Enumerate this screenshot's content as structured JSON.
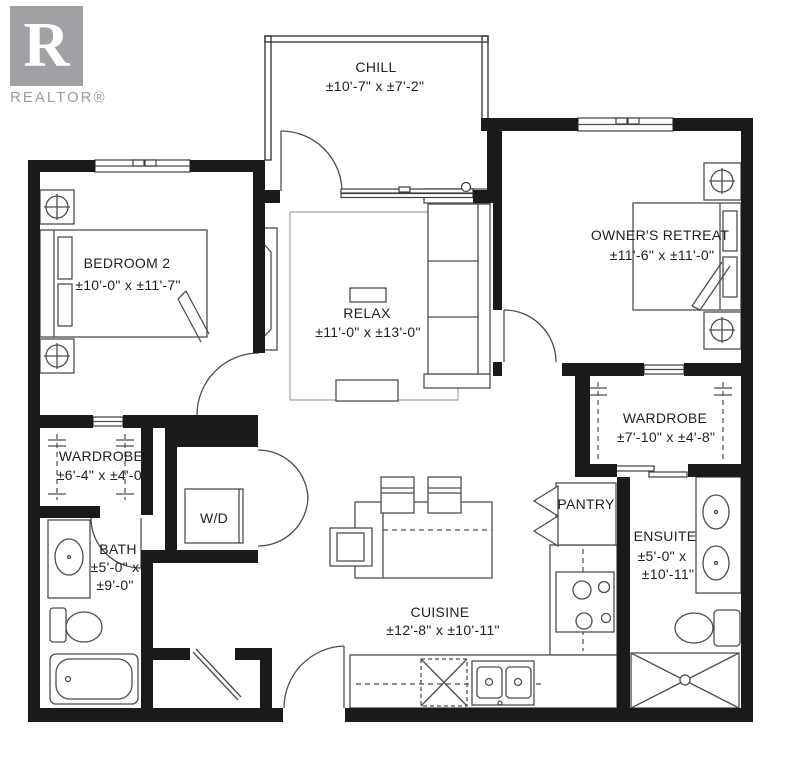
{
  "logo": {
    "letter": "R",
    "brand": "REALTOR®"
  },
  "rooms": {
    "chill": {
      "name": "CHILL",
      "dims": "±10'-7\" x ±7'-2\""
    },
    "bedroom2": {
      "name": "BEDROOM 2",
      "dims": "±10'-0\" x ±11'-7\""
    },
    "relax": {
      "name": "RELAX",
      "dims": "±11'-0\" x ±13'-0\""
    },
    "owners": {
      "name": "OWNER'S RETREAT",
      "dims": "±11'-6\" x ±11'-0\""
    },
    "wardrobe_right": {
      "name": "WARDROBE",
      "dims": "±7'-10\" x ±4'-8\""
    },
    "wardrobe_left": {
      "name": "WARDROBE",
      "dims": "±6'-4\" x ±4'-0\""
    },
    "laundry": {
      "name": "W/D"
    },
    "bath": {
      "name": "BATH",
      "dims_line1": "±5'-0\" x",
      "dims_line2": "±9'-0\""
    },
    "pantry": {
      "name": "PANTRY"
    },
    "ensuite": {
      "name": "ENSUITE",
      "dims_line1": "±5'-0\" x",
      "dims_line2": "±10'-11\""
    },
    "cuisine": {
      "name": "CUISINE",
      "dims": "±12'-8\" x ±10'-11\""
    }
  },
  "colors": {
    "wall": "#1a1a1a",
    "furniture_line": "#4d4d4d",
    "label": "#1f1f1f",
    "logo_gray": "#a0a0a5"
  }
}
